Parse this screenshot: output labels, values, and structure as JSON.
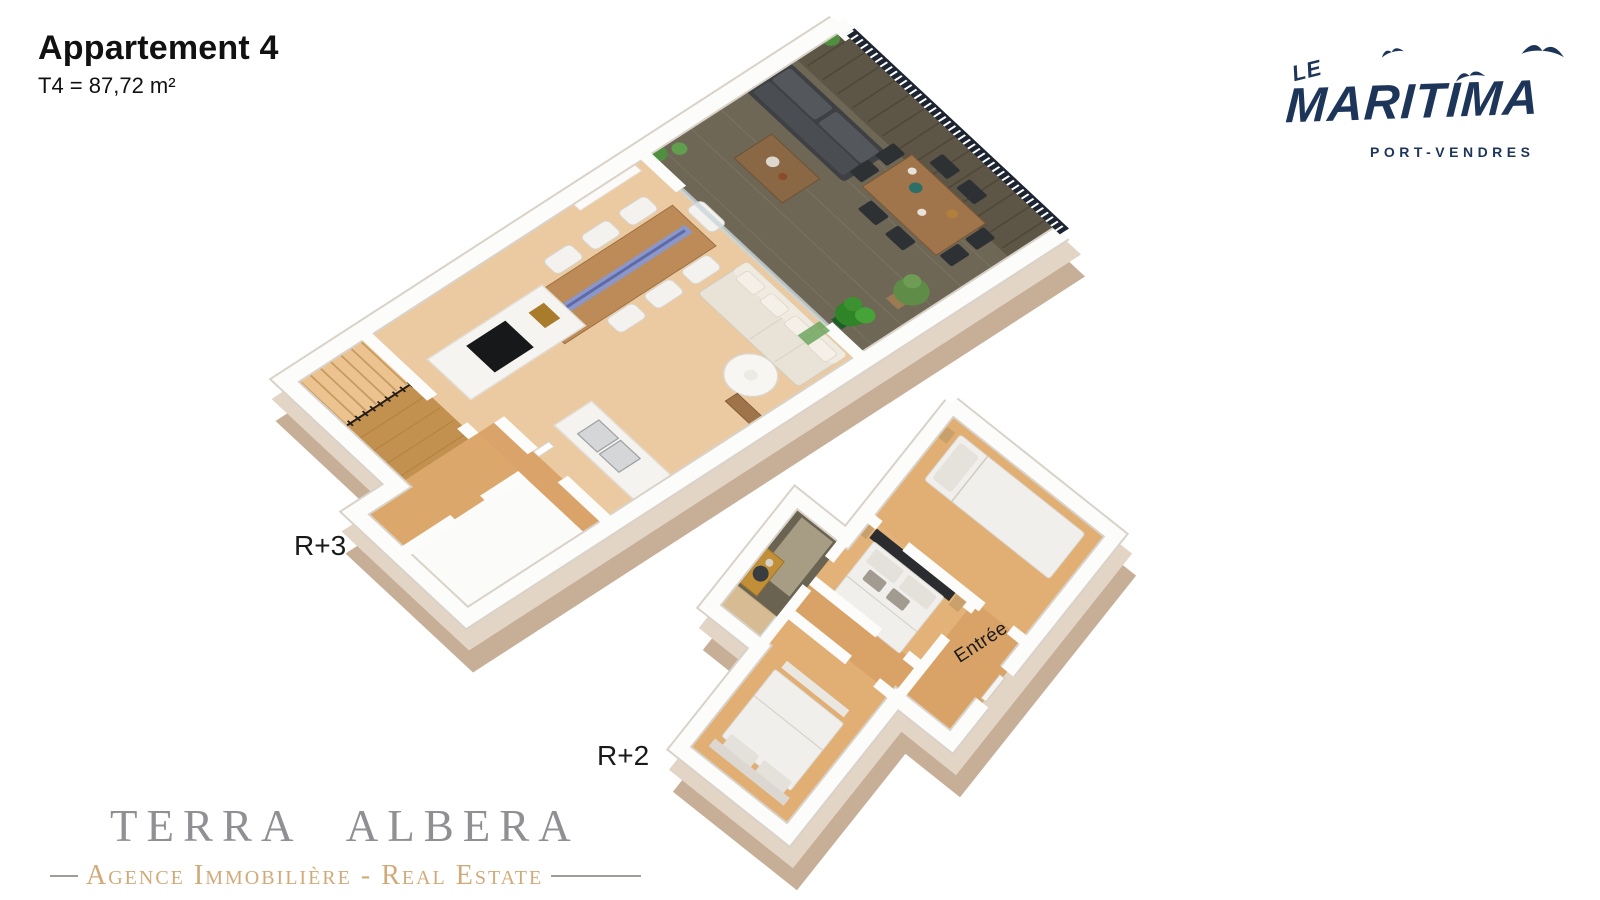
{
  "header": {
    "title": "Appartement 4",
    "subtitle": "T4 = 87,72 m²"
  },
  "brand": {
    "prefix": "LE",
    "name": "MARITIMA",
    "location": "PORT-VENDRES",
    "color": "#1d3558",
    "icons": [
      "bird-icon",
      "bird-icon",
      "bird-icon"
    ]
  },
  "plans": {
    "upper_label": "R+3",
    "lower_label": "R+2",
    "entry_label": "Entrée"
  },
  "agency": {
    "name": "TERRA ALBERA",
    "tagline": "Agence Immobilière - Real Estate",
    "name_color": "#909094",
    "tagline_color": "#d2aa79"
  },
  "palette": {
    "wall_top": "#fcfcfb",
    "wall_rim": "#d9d2c8",
    "wall_face_light": "#e3d5c6",
    "wall_face_dark": "#c6ae97",
    "floor_wood": "#eccaa1",
    "floor_wood_dark": "#d9a267",
    "terrace_deck": "#6f6756",
    "railing": "#1c2531",
    "indoor_sofa": "#e8e2d7",
    "outdoor_sofa": "#3e4043",
    "table_wood": "#bc8b58",
    "table_river_blue": "#8b97c8",
    "kitchen_island": "#f6f4f1",
    "cooktop": "#17181a",
    "bed_linen": "#f1efeb",
    "headboard_dark": "#2b2c30",
    "bathroom_dark": "#6b6351",
    "vanity_gold": "#c08f37",
    "plant_green": "#4f9040"
  }
}
